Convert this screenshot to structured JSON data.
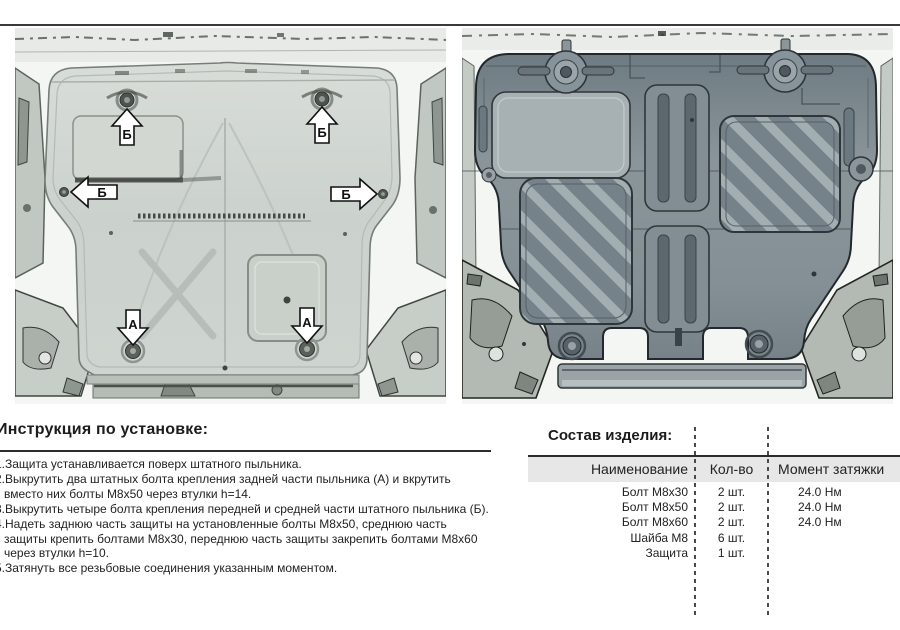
{
  "colors": {
    "rule": "#2b2b2b",
    "table_header_bg": "#e7e7e7",
    "cover_fill": "#cdd3ce",
    "plate_fill": "#808c92"
  },
  "diagrams": {
    "label_a": "А",
    "label_b": "Б"
  },
  "instructions": {
    "title": "Инструкция по установке:",
    "items": [
      {
        "lines": [
          "1.Защита устанавливается поверх штатного пыльника."
        ]
      },
      {
        "lines": [
          "2.Выкрутить два штатных болта крепления задней части пыльника (А) и вкрутить",
          "вместо них болты М8х50 через втулки h=14."
        ]
      },
      {
        "lines": [
          "3.Выкрутить четыре болта крепления передней и средней части штатного пыльника (Б)."
        ]
      },
      {
        "lines": [
          "4.Надеть заднюю часть защиты на установленные болты М8х50, среднюю часть",
          "защиты крепить болтами М8х30, переднюю часть защиты закрепить болтами М8х60",
          "через втулки h=10."
        ]
      },
      {
        "lines": [
          "5.Затянуть все резьбовые соединения указанным моментом."
        ]
      }
    ]
  },
  "parts_table": {
    "title": "Состав изделия:",
    "headers": [
      "Наименование",
      "Кол-во",
      "Момент затяжки"
    ],
    "rows": [
      {
        "name": "Болт М8х30",
        "qty": "2 шт.",
        "torque": "24.0 Нм"
      },
      {
        "name": "Болт М8х50",
        "qty": "2 шт.",
        "torque": "24.0 Нм"
      },
      {
        "name": "Болт М8х60",
        "qty": "2 шт.",
        "torque": "24.0 Нм"
      },
      {
        "name": "Шайба М8",
        "qty": "6 шт.",
        "torque": ""
      },
      {
        "name": "Защита",
        "qty": "1 шт.",
        "torque": ""
      }
    ]
  }
}
